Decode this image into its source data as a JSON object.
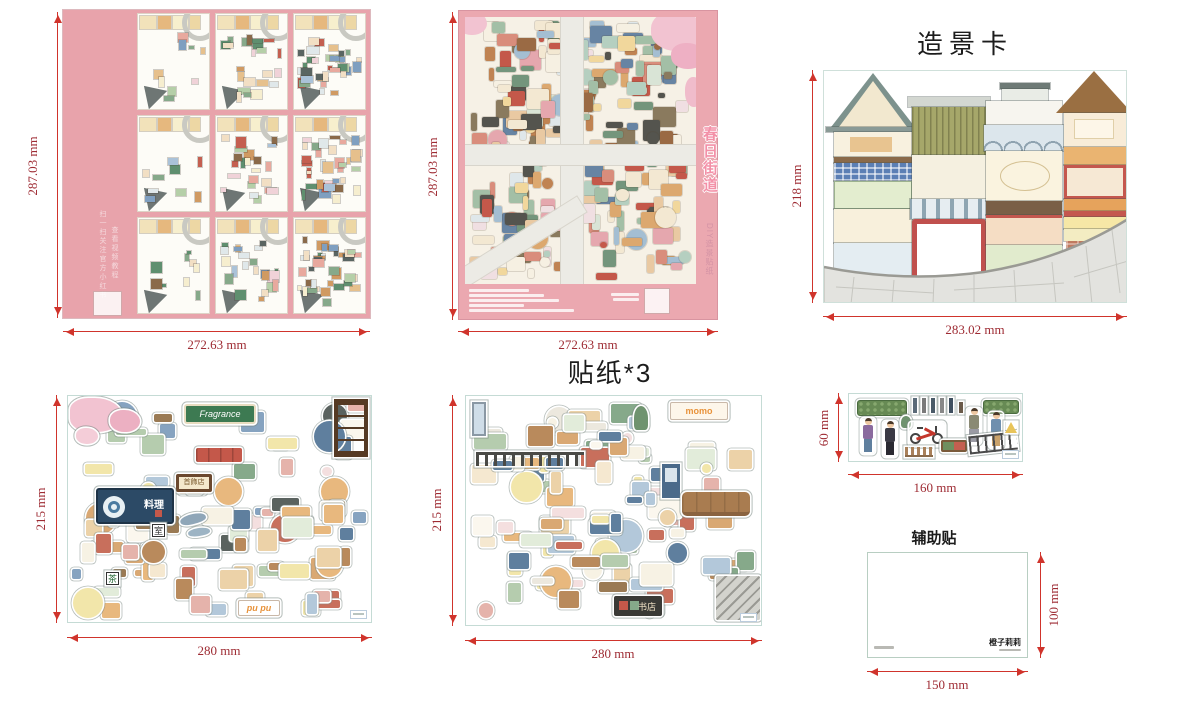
{
  "colors": {
    "dim_line": "#d0342c",
    "dim_text": "#9e2b33",
    "board_pink": "#e8a3ab",
    "poster_pink": "#eba8b0",
    "sheet_border": "#c5dbd5"
  },
  "titles": {
    "scene_card": "造景卡",
    "stickers": "贴纸*3",
    "aux": "辅助贴"
  },
  "board": {
    "height": "287.03 mm",
    "width": "272.63 mm",
    "side_text_main": "扫一扫关注官方小红书",
    "side_text_sub": "查看视频教程"
  },
  "poster": {
    "height": "287.03 mm",
    "width": "272.63 mm",
    "vertical_title": "春日街道",
    "vertical_subtitle": "DIY造景贴纸"
  },
  "scene_card": {
    "height": "218 mm",
    "width": "283.02 mm"
  },
  "sticker_sheet_1": {
    "height": "215 mm",
    "width": "280 mm",
    "signs": {
      "fragrance": "Fragrance",
      "restaurant": "料理",
      "jewelry": "首飾店",
      "tea": "茶",
      "room": "室",
      "pupu": "pu pu"
    }
  },
  "sticker_sheet_2": {
    "height": "215 mm",
    "width": "280 mm",
    "signs": {
      "momo": "momo",
      "bookstore": "书店"
    }
  },
  "strip": {
    "height": "60 mm",
    "width": "160 mm"
  },
  "aux": {
    "height": "100 mm",
    "width": "150 mm",
    "brand": "橙子莉莉"
  },
  "decor": {
    "poster_mosaic": {
      "seed": 9,
      "count": 250,
      "palette": [
        "#e9c9a2",
        "#dca86f",
        "#c08352",
        "#9a6a44",
        "#f3e8d2",
        "#d9e4d6",
        "#a3bfa6",
        "#74957c",
        "#f1d79c",
        "#dfe7ea",
        "#a4bed2",
        "#6784a3",
        "#d98d7c",
        "#c4584a",
        "#f0dfe2",
        "#e5a7ae",
        "#8a7a5e",
        "#54544e",
        "#f6f0e2",
        "#b5cfc0"
      ]
    },
    "sheet1_mosaic": {
      "seed": 17,
      "count": 95,
      "palette": [
        "#f5e8d0",
        "#ecd2a8",
        "#d9a873",
        "#b98a5c",
        "#f7f2e4",
        "#e2ecda",
        "#b5ccae",
        "#86a98a",
        "#f4dfdf",
        "#e5b3ab",
        "#c86f5c",
        "#b3c8da",
        "#86a3c0",
        "#5f7f9e",
        "#ece8de",
        "#9a7a54",
        "#5a625f",
        "#f2e6aa",
        "#e8b87e",
        "#fbf7ee"
      ]
    },
    "sheet2_mosaic": {
      "seed": 29,
      "count": 100,
      "palette": [
        "#f5e8d0",
        "#ecd2a8",
        "#d9a873",
        "#b98a5c",
        "#f7f2e4",
        "#e2ecda",
        "#b5ccae",
        "#86a98a",
        "#f4dfdf",
        "#e5b3ab",
        "#c86f5c",
        "#b3c8da",
        "#86a3c0",
        "#5f7f9e",
        "#ece8de",
        "#9a7a54",
        "#5a625f",
        "#f2e6aa",
        "#e8b87e",
        "#fbf7ee"
      ]
    },
    "mini": {
      "counts": [
        9,
        22,
        36
      ],
      "palette": [
        "#f2dfc4",
        "#e6c08c",
        "#d09a62",
        "#b5cfa8",
        "#86a98a",
        "#5f8f6f",
        "#e8a99e",
        "#c45f50",
        "#aac2d8",
        "#7f9fc0",
        "#f6eecf",
        "#8a6a4a",
        "#5a6562",
        "#f0d2d8",
        "#e0e8ea"
      ]
    }
  }
}
